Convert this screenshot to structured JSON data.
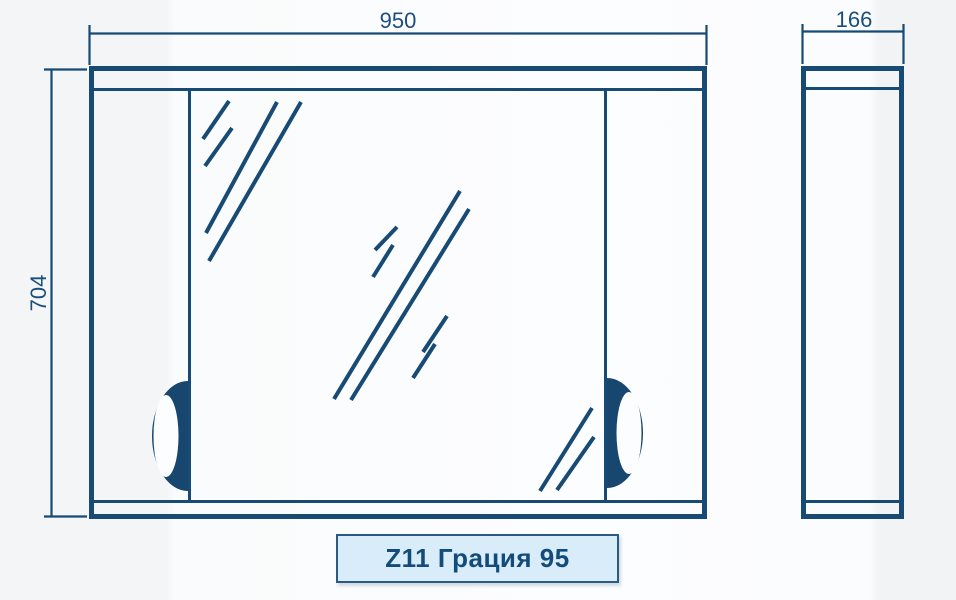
{
  "product_label": "Z11 Грация 95",
  "dimensions": {
    "width_label": "950",
    "height_label": "704",
    "depth_label": "166"
  },
  "colors": {
    "line": "#174a74",
    "dimension_text": "#1b4e7e",
    "handle_fill": "#17466f",
    "label_box_fill": "#d9ecf9",
    "label_box_border": "#2a5a84",
    "label_text": "#134b7a",
    "background": "#f8fafb"
  }
}
